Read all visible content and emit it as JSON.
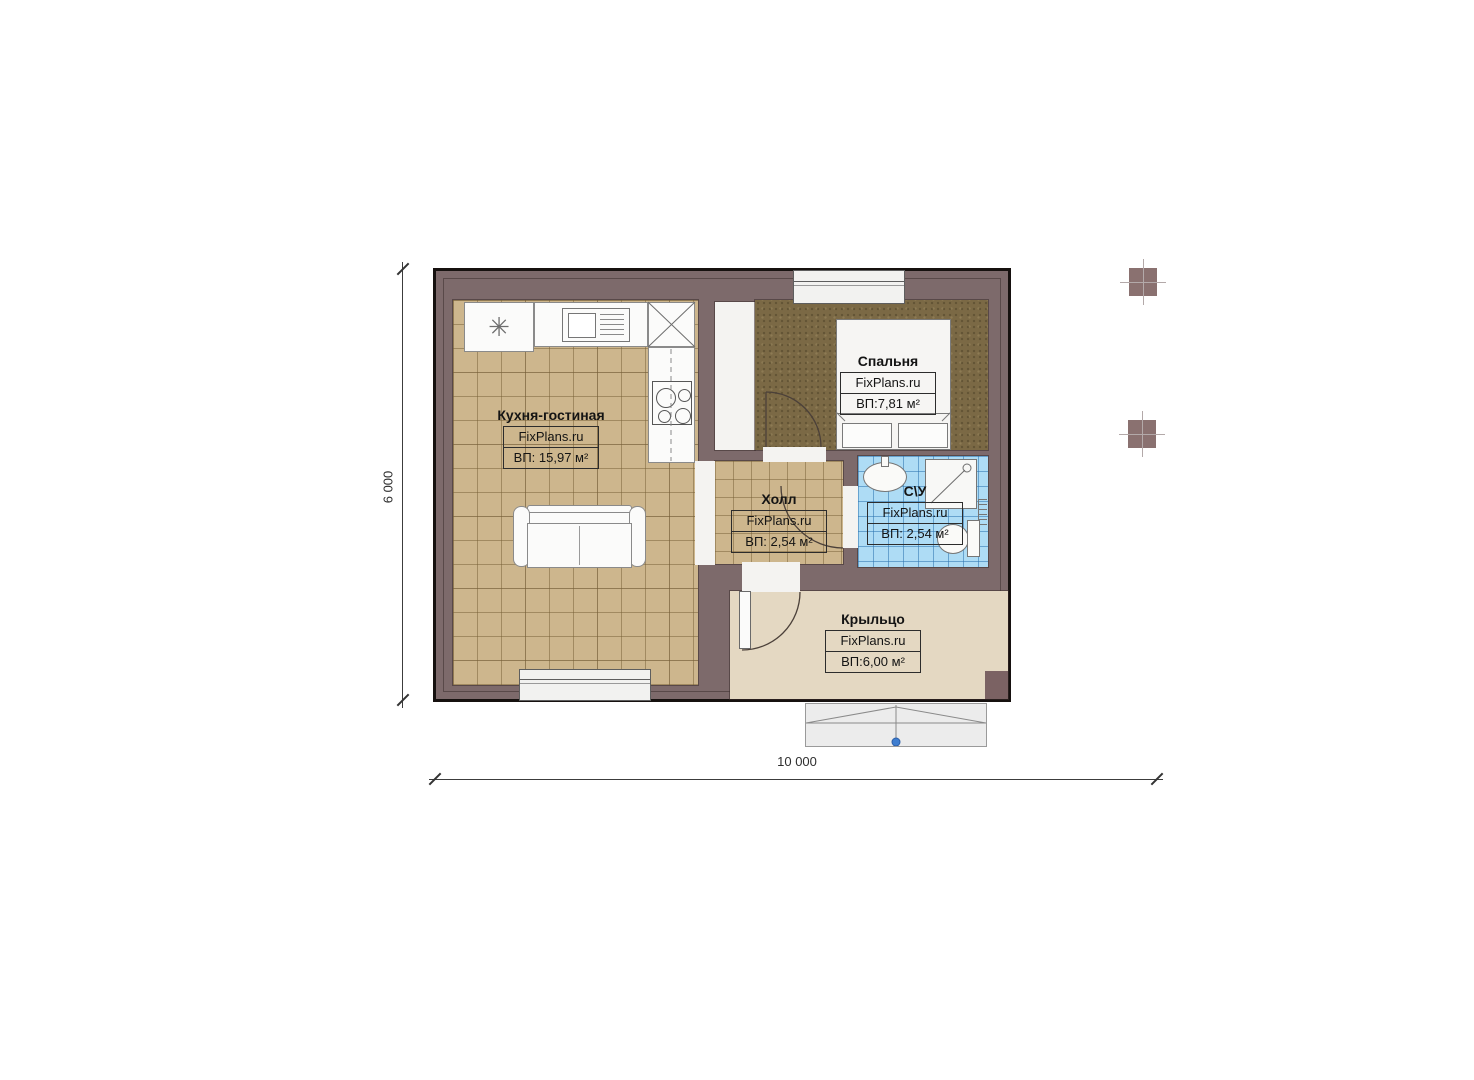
{
  "plan_title": "Floor plan",
  "rooms": [
    {
      "title": "Кухня-гостиная",
      "brand": "FixPlans.ru",
      "area": "ВП: 15,97 м²"
    },
    {
      "title": "Спальня",
      "brand": "FixPlans.ru",
      "area": "ВП:7,81 м²"
    },
    {
      "title": "Холл",
      "brand": "FixPlans.ru",
      "area": "ВП: 2,54 м²"
    },
    {
      "title": "С\\У",
      "brand": "FixPlans.ru",
      "area": "ВП: 2,54 м²"
    },
    {
      "title": "Крыльцо",
      "brand": "FixPlans.ru",
      "area": "ВП:6,00 м²"
    }
  ],
  "dimensions": {
    "height_label": "6 000",
    "width_label": "10 000"
  },
  "symbols": {
    "kitchen_corner": "✳"
  },
  "colors": {
    "wall": "#7d6a6b",
    "outline": "#16110f",
    "tile_beige": "#cdb68d",
    "bedroom_floor": "#7b6945",
    "bathroom_tile": "#aedcf5",
    "porch_floor": "#e4d8c2",
    "step_marker_blue": "#3f7ed0"
  }
}
